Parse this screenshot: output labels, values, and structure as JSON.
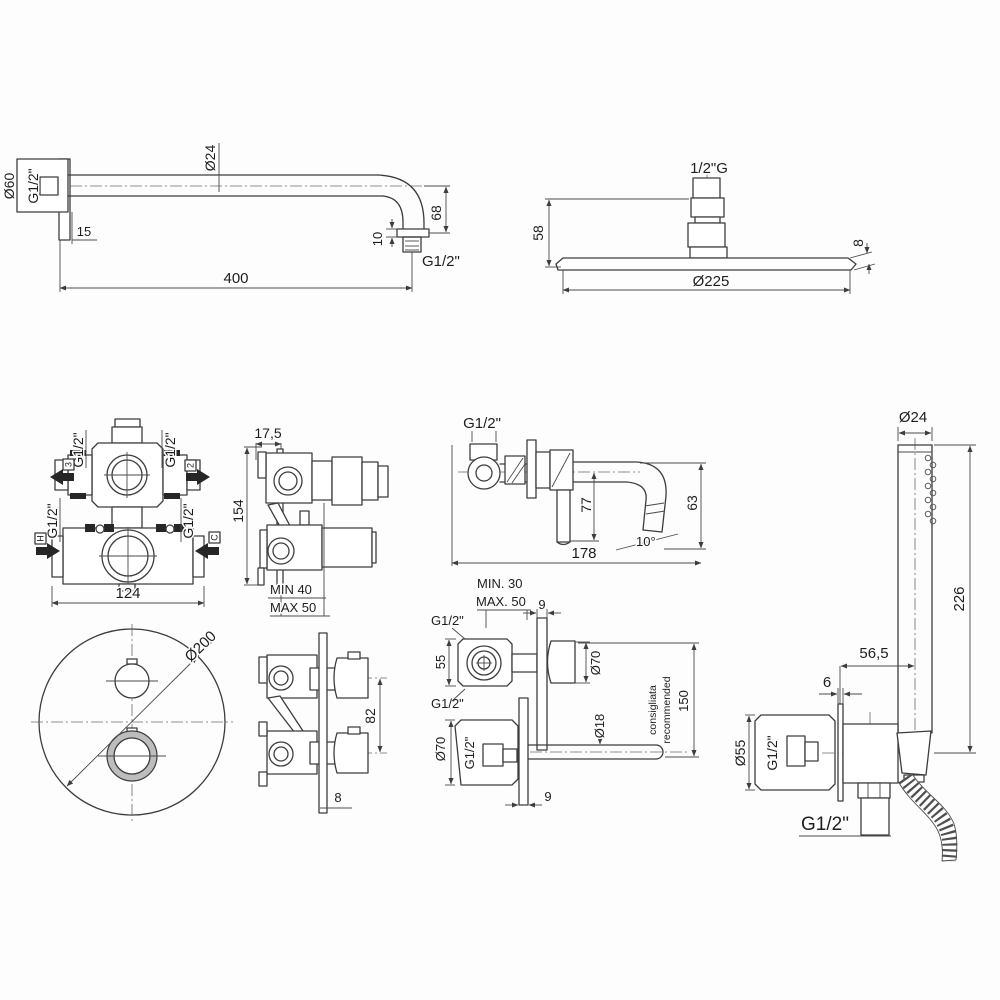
{
  "page": {
    "background": "#fdfdfd",
    "line_color": "#3d3d3d"
  },
  "labels": {
    "arm": {
      "d60": "Ø60",
      "g12_in": "G1/2\"",
      "d24": "Ø24",
      "off15": "15",
      "h10": "10",
      "h68": "68",
      "g12_out": "G1/2\"",
      "len400": "400"
    },
    "head": {
      "thread": "1/2\"G",
      "h58": "58",
      "t8": "8",
      "d225": "Ø225"
    },
    "valve": {
      "g12_tl": "G1/2\"",
      "g12_tr": "G1/2\"",
      "g12_bl": "G1/2\"",
      "g12_br": "G1/2\"",
      "p3": "3",
      "p2": "2",
      "ph": "H",
      "pc": "C",
      "w124": "124",
      "h154": "154",
      "d175": "17,5",
      "min40": "MIN 40",
      "max50": "MAX 50"
    },
    "spout": {
      "g12": "G1/2\"",
      "v77": "77",
      "v63": "63",
      "a10": "10°",
      "r178": "178",
      "min30": "MIN. 30",
      "max50": "MAX. 50"
    },
    "mixer": {
      "p9": "9",
      "g12_top": "G1/2\"",
      "h55": "55",
      "g12_bot": "G1/2\"",
      "d70": "Ø70"
    },
    "spout_sec": {
      "d70": "Ø70",
      "g12": "G1/2\"",
      "d18": "Ø18",
      "v150": "150",
      "note_it": "consigliata",
      "note_en": "recommended",
      "p9": "9"
    },
    "plate": {
      "d200": "Ø200",
      "c82": "82",
      "t8": "8"
    },
    "hand": {
      "d24": "Ø24",
      "l226": "226",
      "off565": "56,5",
      "p6": "6",
      "d55": "Ø55",
      "g12_side": "G1/2\"",
      "g12_bot": "G1/2\""
    }
  }
}
